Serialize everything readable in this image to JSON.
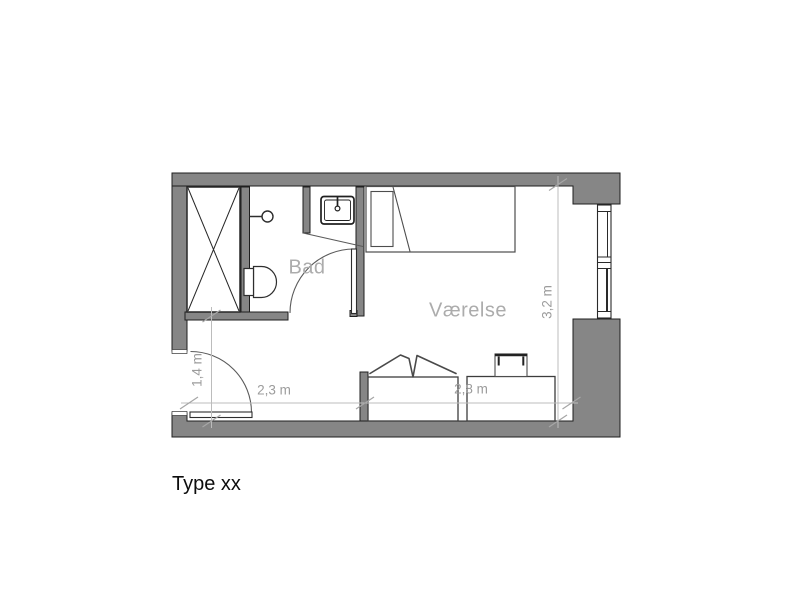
{
  "plan": {
    "title": "Type xx",
    "rooms": [
      {
        "name": "Bad"
      },
      {
        "name": "Værelse"
      }
    ],
    "dimensions": {
      "entry_depth": "1,4 m",
      "entry_width": "2,3 m",
      "desk_wall": "2,8 m",
      "room_depth": "3,2 m"
    },
    "fixtures": [
      "wardrobe-symbol",
      "shower-symbol",
      "toilet-symbol",
      "sink-symbol",
      "bathroom-door-symbol",
      "entry-door-symbol",
      "bed-symbol",
      "desk-symbol-left",
      "desk-symbol-right",
      "chair-symbol-left",
      "chair-symbol-right",
      "window-symbol"
    ],
    "colors": {
      "wall_fill": "#868686",
      "wall_outline": "#1f1f1f",
      "fixture_outline": "#2e2e2e",
      "dimension_line": "#bcbcbc",
      "dimension_text": "#9c9c9c",
      "room_label": "#acacac",
      "title_text": "#0d0d0d"
    }
  }
}
